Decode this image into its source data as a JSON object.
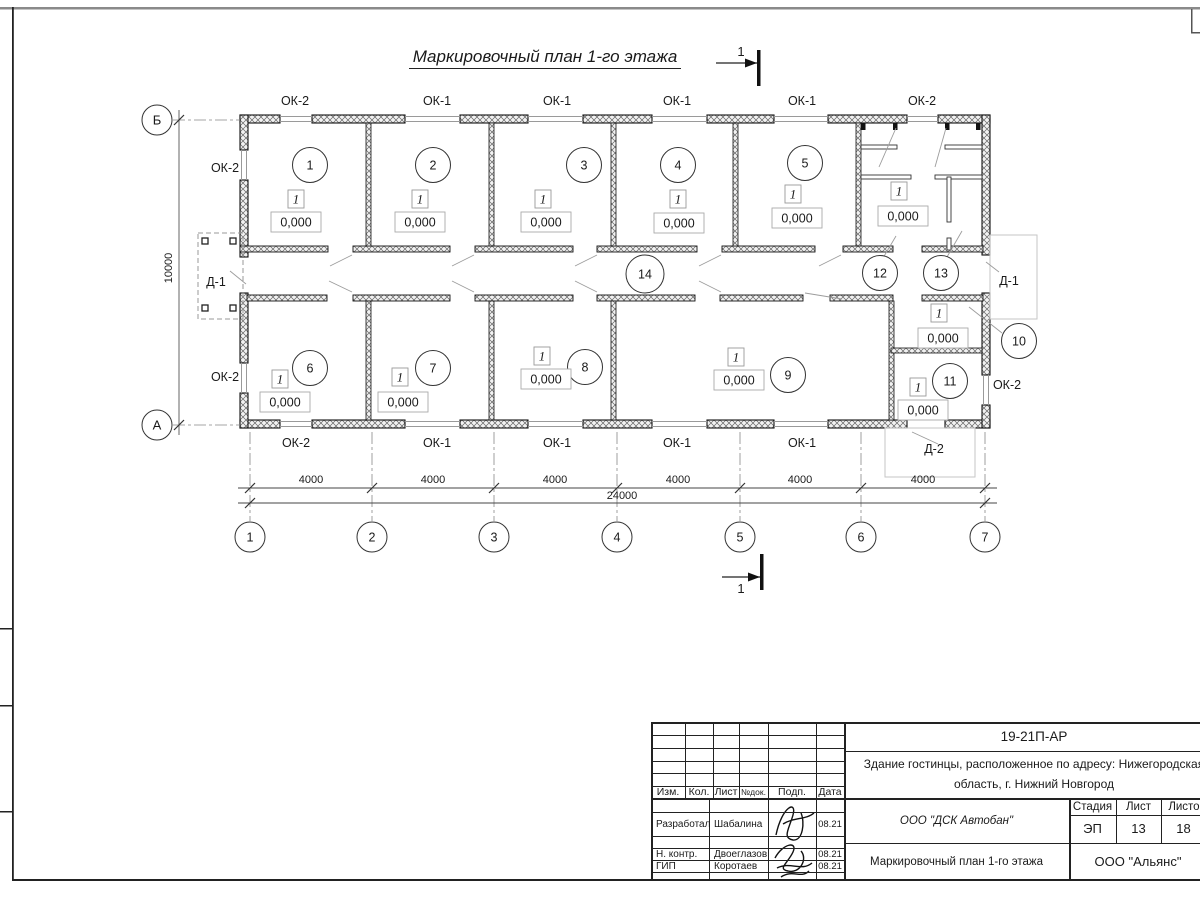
{
  "sheet": {
    "title": "Маркировочный план 1-го этажа",
    "section_label": "1"
  },
  "plan": {
    "floor_type_label": "1",
    "elevation_label": "0,000",
    "room_numbers": [
      {
        "n": "1",
        "x": 310,
        "y": 165
      },
      {
        "n": "2",
        "x": 433,
        "y": 165
      },
      {
        "n": "3",
        "x": 584,
        "y": 165
      },
      {
        "n": "4",
        "x": 678,
        "y": 165
      },
      {
        "n": "5",
        "x": 805,
        "y": 163
      },
      {
        "n": "6",
        "x": 310,
        "y": 368
      },
      {
        "n": "7",
        "x": 433,
        "y": 368
      },
      {
        "n": "8",
        "x": 585,
        "y": 367
      },
      {
        "n": "9",
        "x": 788,
        "y": 375
      },
      {
        "n": "10",
        "x": 1019,
        "y": 341
      },
      {
        "n": "11",
        "x": 950,
        "y": 381
      },
      {
        "n": "12",
        "x": 880,
        "y": 273
      },
      {
        "n": "13",
        "x": 941,
        "y": 273
      },
      {
        "n": "14",
        "x": 645,
        "y": 274
      }
    ],
    "floor_marks": [
      {
        "x": 296,
        "y": 199,
        "bx": 296,
        "by": 222
      },
      {
        "x": 420,
        "y": 199,
        "bx": 420,
        "by": 222
      },
      {
        "x": 543,
        "y": 199,
        "bx": 546,
        "by": 222
      },
      {
        "x": 678,
        "y": 199,
        "bx": 679,
        "by": 223
      },
      {
        "x": 793,
        "y": 194,
        "bx": 797,
        "by": 218
      },
      {
        "x": 899,
        "y": 191,
        "bx": 903,
        "by": 216
      },
      {
        "x": 280,
        "y": 379,
        "bx": 285,
        "by": 402
      },
      {
        "x": 400,
        "y": 377,
        "bx": 403,
        "by": 402
      },
      {
        "x": 542,
        "y": 356,
        "bx": 546,
        "by": 379
      },
      {
        "x": 736,
        "y": 357,
        "bx": 739,
        "by": 380
      },
      {
        "x": 939,
        "y": 313,
        "bx": 943,
        "by": 338
      },
      {
        "x": 918,
        "y": 387,
        "bx": 923,
        "by": 410
      }
    ],
    "window_labels": [
      {
        "t": "ОК-2",
        "x": 295,
        "y": 101
      },
      {
        "t": "ОК-1",
        "x": 437,
        "y": 101
      },
      {
        "t": "ОК-1",
        "x": 557,
        "y": 101
      },
      {
        "t": "ОК-1",
        "x": 677,
        "y": 101
      },
      {
        "t": "ОК-1",
        "x": 802,
        "y": 101
      },
      {
        "t": "ОК-2",
        "x": 922,
        "y": 101
      },
      {
        "t": "ОК-2",
        "x": 296,
        "y": 443
      },
      {
        "t": "ОК-1",
        "x": 437,
        "y": 443
      },
      {
        "t": "ОК-1",
        "x": 557,
        "y": 443
      },
      {
        "t": "ОК-1",
        "x": 677,
        "y": 443
      },
      {
        "t": "ОК-1",
        "x": 802,
        "y": 443
      },
      {
        "t": "ОК-2",
        "x": 225,
        "y": 168
      },
      {
        "t": "ОК-2",
        "x": 225,
        "y": 377
      },
      {
        "t": "ОК-2",
        "x": 1007,
        "y": 385
      }
    ],
    "door_labels": [
      {
        "t": "Д-1",
        "x": 216,
        "y": 282
      },
      {
        "t": "Д-1",
        "x": 1009,
        "y": 281
      },
      {
        "t": "Д-2",
        "x": 934,
        "y": 449
      }
    ],
    "axes_bottom": [
      {
        "n": "1",
        "x": 250
      },
      {
        "n": "2",
        "x": 372
      },
      {
        "n": "3",
        "x": 494
      },
      {
        "n": "4",
        "x": 617
      },
      {
        "n": "5",
        "x": 740
      },
      {
        "n": "6",
        "x": 861
      },
      {
        "n": "7",
        "x": 985
      }
    ],
    "axes_left": [
      {
        "n": "Б",
        "y": 120
      },
      {
        "n": "А",
        "y": 425
      }
    ],
    "dim_segments": [
      {
        "t": "4000",
        "x": 311
      },
      {
        "t": "4000",
        "x": 433
      },
      {
        "t": "4000",
        "x": 555
      },
      {
        "t": "4000",
        "x": 678
      },
      {
        "t": "4000",
        "x": 800
      },
      {
        "t": "4000",
        "x": 923
      }
    ],
    "dim_total": {
      "t": "24000",
      "x": 622,
      "y": 499
    },
    "dim_vertical": {
      "t": "10000",
      "x": 172,
      "y": 268
    }
  },
  "titleblock": {
    "doc_number": "19-21П-АР",
    "project_line1": "Здание гостинцы, расположенное по адресу: Нижегородская",
    "project_line2": "область, г. Нижний Новгород",
    "change_cols": [
      "Изм.",
      "Кол.",
      "Лист",
      "№док.",
      "Подп.",
      "Дата"
    ],
    "rows": [
      {
        "role": "Разработал",
        "name": "Шабалина",
        "date": "08.21"
      },
      {
        "role": "Н. контр.",
        "name": "Двоеглазов",
        "date": "08.21"
      },
      {
        "role": "ГИП",
        "name": "Коротаев",
        "date": "08.21"
      }
    ],
    "company": "ООО \"ДСК Автобан\"",
    "sheet_title": "Маркировочный план 1-го этажа",
    "org": "ООО \"Альянс\"",
    "stage_label": "Стадия",
    "sheet_label": "Лист",
    "sheets_label": "Листов",
    "stage": "ЭП",
    "sheet_num": "13",
    "sheets_total": "18"
  },
  "colors": {
    "line": "#1a1a1a",
    "thin": "#999999",
    "frame_gray": "#8a8a8a"
  }
}
